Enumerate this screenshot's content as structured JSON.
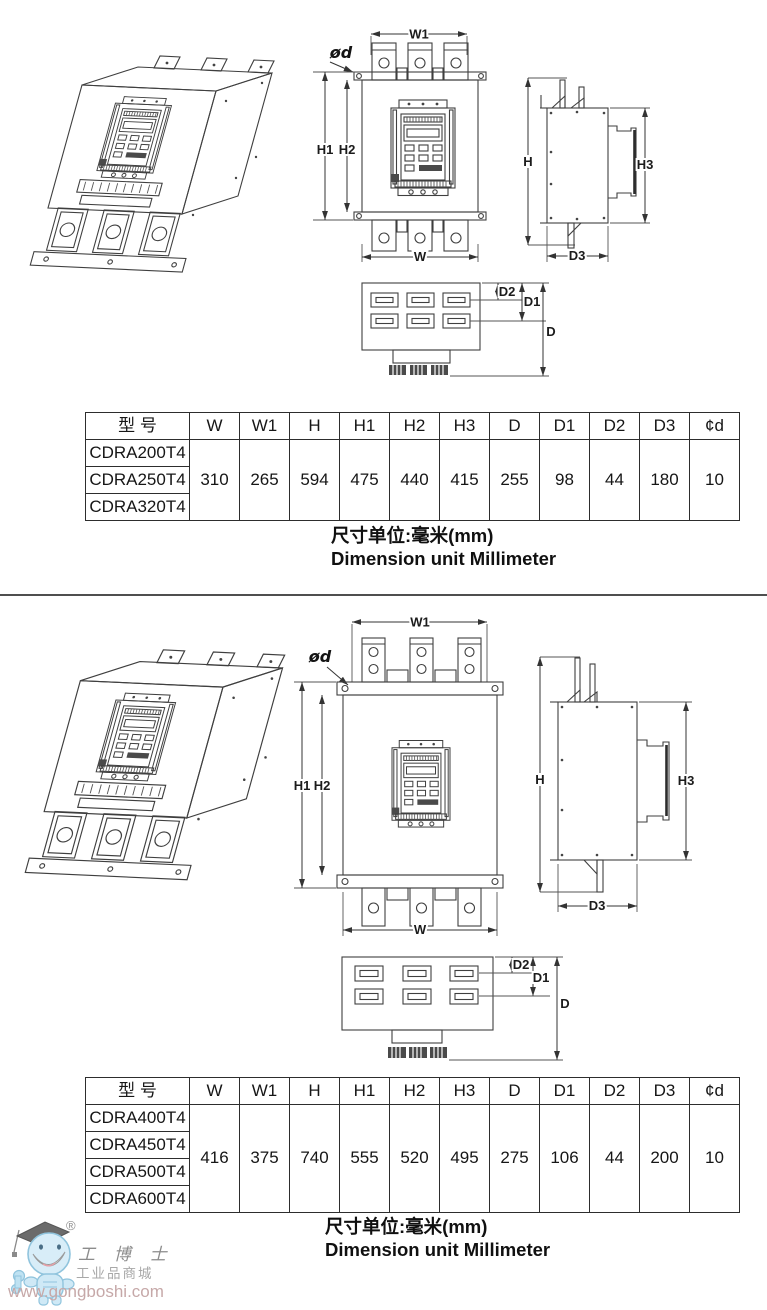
{
  "dims": {
    "w1": "W1",
    "phi_d": "ød",
    "h1": "H1",
    "h2": "H2",
    "w": "W",
    "h": "H",
    "h3": "H3",
    "d3": "D3",
    "d2": "D2",
    "d1": "D1",
    "d": "D"
  },
  "section1": {
    "table": {
      "model_header": "型  号",
      "dim_headers": [
        "W",
        "W1",
        "H",
        "H1",
        "H2",
        "H3",
        "D",
        "D1",
        "D2",
        "D3",
        "¢d"
      ],
      "models": [
        "CDRA200T4",
        "CDRA250T4",
        "CDRA320T4"
      ],
      "values": [
        "310",
        "265",
        "594",
        "475",
        "440",
        "415",
        "255",
        "98",
        "44",
        "180",
        "10"
      ]
    },
    "caption_cn": "尺寸单位:毫米(mm)",
    "caption_en": "Dimension unit Millimeter"
  },
  "section2": {
    "table": {
      "model_header": "型  号",
      "dim_headers": [
        "W",
        "W1",
        "H",
        "H1",
        "H2",
        "H3",
        "D",
        "D1",
        "D2",
        "D3",
        "¢d"
      ],
      "models": [
        "CDRA400T4",
        "CDRA450T4",
        "CDRA500T4",
        "CDRA600T4"
      ],
      "values": [
        "416",
        "375",
        "740",
        "555",
        "520",
        "495",
        "275",
        "106",
        "44",
        "200",
        "10"
      ]
    },
    "caption_cn": "尺寸单位:毫米(mm)",
    "caption_en": "Dimension unit Millimeter"
  },
  "watermark": {
    "registered": "®",
    "brand": "工 博 士",
    "subtitle": "工业品商城",
    "url": "www.gongboshi.com"
  }
}
